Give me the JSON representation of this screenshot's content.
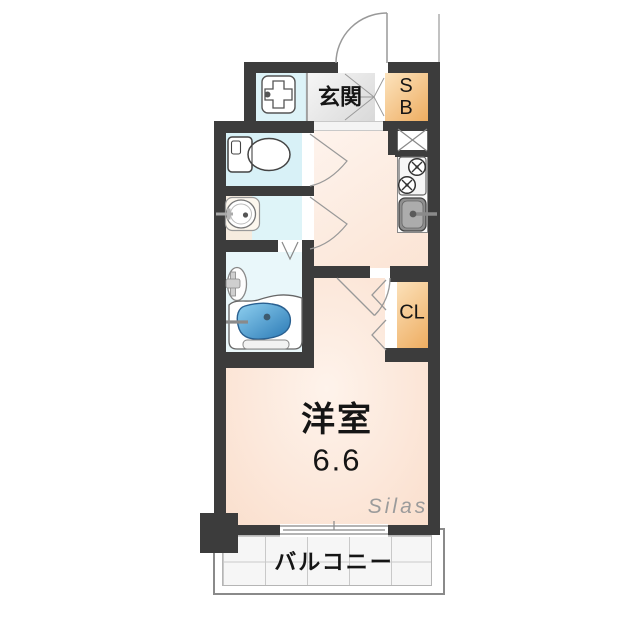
{
  "labels": {
    "entrance": "玄関",
    "shoe_box_line1": "S",
    "shoe_box_line2": "B",
    "closet": "CL",
    "main_room_name": "洋室",
    "main_room_size": "6.6",
    "balcony": "バルコニー",
    "watermark": "Silas"
  },
  "fixtures": {
    "entrance_door": "hinged-door-arc",
    "washing_machine_pan": "cross-in-square-symbol",
    "toilet": "tank-and-bowl-symbol",
    "washbasin": "oval-basin-with-faucet",
    "shower": "wall-shower-symbol",
    "bathtub": "blue-tub-symbol",
    "stove": "two-burner-stove-symbol",
    "kitchen_sink": "gray-sink-with-faucet",
    "refrigerator_space": "x-crossed-box-symbol",
    "closet_door": "folding-door-chevrons",
    "balcony_window": "sliding-window-symbol"
  },
  "colors": {
    "wall": "#3c3c3c",
    "room_floor": "#fce8db",
    "wet_area_floor": "#d8f1f7",
    "storage_gradient_light": "#fce3bd",
    "storage_gradient_dark": "#eead61",
    "entrance_floor": "#e5e5e5",
    "bathtub_blue": "#3f93cf",
    "balcony_tile": "#f6f6f6",
    "watermark_gray": "#9b9b9b"
  }
}
